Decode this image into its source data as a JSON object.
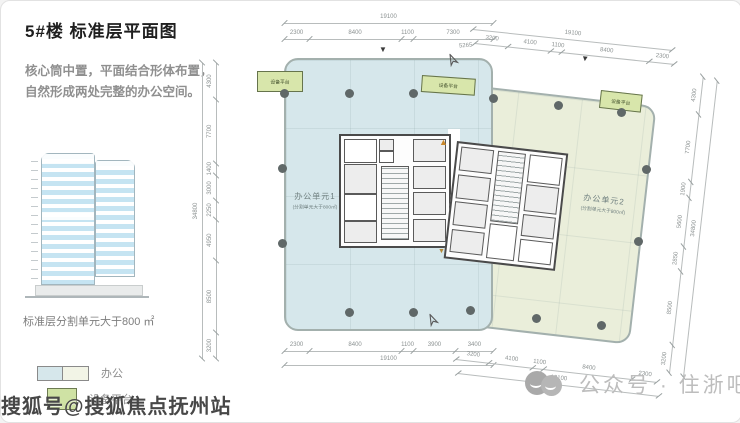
{
  "panel": {
    "title": "5#楼 标准层平面图",
    "description_line1": "核心筒中置，平面结合形体布置，",
    "description_line2": "自然形成两处完整的办公空间。",
    "elevation_caption": "标准层分割单元大于800 ㎡",
    "legend_office_label": "办公",
    "legend_platform_label": "设备平台"
  },
  "watermarks": {
    "bottom_left": "搜狐号@搜狐焦点抚州站",
    "bottom_right": "公众号 · 住浙吧"
  },
  "plan": {
    "unit1_name": "办公单元1",
    "unit1_sub": "(分割单元大于800㎡)",
    "unit2_name": "办公单元2",
    "unit2_sub": "(分割单元大于800㎡)",
    "platform_label": "设备平台",
    "colors": {
      "unit1": "#d6e7eb",
      "unit2": "#eaeeda",
      "platform": "#d8e6ab",
      "column": "#606868",
      "dimension_text": "#8b9191"
    },
    "chains": [
      {
        "x": 283,
        "y": 14,
        "len": 209,
        "angle": 0,
        "labels": [
          "19100"
        ]
      },
      {
        "x": 283,
        "y": 30,
        "len": 209,
        "angle": 0,
        "labels": [
          "2300",
          "8400",
          "1100",
          "7300"
        ]
      },
      {
        "x": 472,
        "y": 20,
        "len": 200,
        "angle": 6,
        "labels": [
          "19100"
        ]
      },
      {
        "x": 474,
        "y": 34,
        "len": 200,
        "angle": 6,
        "labels": [
          "3200",
          "4100",
          "1100",
          "8400",
          "2300"
        ]
      },
      {
        "x": 283,
        "y": 342,
        "len": 209,
        "angle": 0,
        "labels": [
          "2300",
          "8400",
          "1100",
          "3900",
          "3400"
        ]
      },
      {
        "x": 283,
        "y": 356,
        "len": 209,
        "angle": 0,
        "labels": [
          "19100"
        ]
      },
      {
        "x": 455,
        "y": 350,
        "len": 202,
        "angle": 6.5,
        "labels": [
          "3200",
          "4100",
          "1100",
          "8400",
          "2300"
        ]
      },
      {
        "x": 457,
        "y": 364,
        "len": 202,
        "angle": 6.5,
        "labels": [
          "19100"
        ]
      },
      {
        "x": 213,
        "y": 352,
        "len": 296,
        "angle": -90,
        "labels": [
          "3200",
          "8500",
          "4950",
          "2250",
          "3000",
          "1400",
          "7700",
          "4300"
        ]
      },
      {
        "x": 199,
        "y": 352,
        "len": 296,
        "angle": -90,
        "labels": [
          "34800"
        ]
      },
      {
        "x": 666,
        "y": 366,
        "len": 298,
        "angle": -83.5,
        "labels": [
          "3200",
          "8500",
          "2850",
          "5600",
          "1900",
          "7700",
          "4300"
        ]
      },
      {
        "x": 680,
        "y": 370,
        "len": 298,
        "angle": -83.5,
        "labels": [
          "34800"
        ]
      }
    ],
    "annotations": [
      {
        "text": "5265",
        "x": 458,
        "y": 42,
        "rot": -4
      }
    ],
    "columns": [
      [
        283,
        92
      ],
      [
        348,
        92
      ],
      [
        412,
        92
      ],
      [
        281,
        167
      ],
      [
        281,
        242
      ],
      [
        348,
        311
      ],
      [
        412,
        311
      ],
      [
        492,
        97
      ],
      [
        557,
        104
      ],
      [
        620,
        111
      ],
      [
        469,
        309
      ],
      [
        535,
        317
      ],
      [
        600,
        324
      ],
      [
        645,
        168
      ],
      [
        637,
        240
      ]
    ],
    "markers": [
      {
        "glyph": "▼",
        "x": 378,
        "y": 45,
        "color": "#3a3a3a",
        "rot": 0,
        "size": 8
      },
      {
        "glyph": "▼",
        "x": 580,
        "y": 54,
        "color": "#3a3a3a",
        "rot": 6,
        "size": 8
      },
      {
        "glyph": "▲",
        "x": 438,
        "y": 137,
        "color": "#c8872b",
        "rot": 0,
        "size": 9
      },
      {
        "glyph": "▼",
        "x": 437,
        "y": 247,
        "color": "#b58a3a",
        "rot": 0,
        "size": 7
      }
    ],
    "north_arrows": [
      {
        "x": 446,
        "y": 52,
        "rot": -25
      },
      {
        "x": 426,
        "y": 312,
        "rot": -25
      }
    ]
  }
}
